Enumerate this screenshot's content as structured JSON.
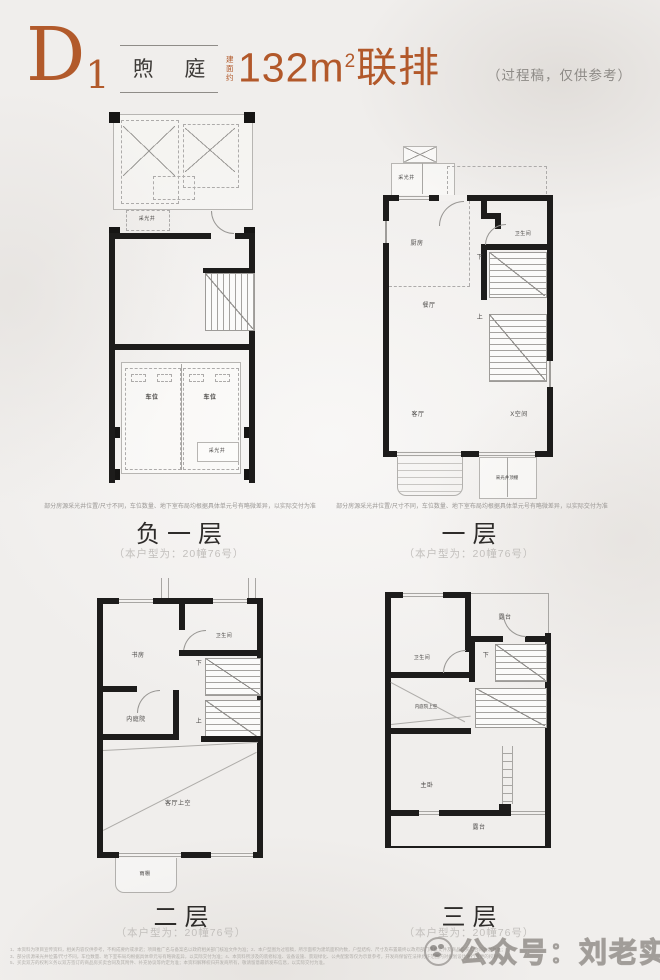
{
  "header": {
    "type_letter": "D",
    "type_number": "1",
    "name": "煦 庭",
    "area_prefix": "建面约",
    "area_value": "132m",
    "area_sup": "2",
    "area_type": "联排",
    "note": "（过程稿，仅供参考）",
    "accent_color": "#b2582a"
  },
  "caption": "（本户型为：20幢76号）",
  "disclaimer": "部分房源采光井位置/尺寸不同，车位数量、地下室布局均根据具体单元号有略微差异，以实际交付为准",
  "plans": {
    "basement": {
      "title": "负一层",
      "labels": {
        "lightwell_top": "采光井",
        "parking_left": "车位",
        "parking_right": "车位",
        "lightwell_bottom": "采光井"
      }
    },
    "floor1": {
      "title": "一层",
      "labels": {
        "lightwell": "采光井",
        "kitchen": "厨房",
        "bath": "卫生间",
        "down": "下",
        "up": "上",
        "dining": "餐厅",
        "living": "客厅",
        "xspace": "X空间",
        "lightwell_cover": "采光井顶棚"
      }
    },
    "floor2": {
      "title": "二层",
      "labels": {
        "study": "书房",
        "bath": "卫生间",
        "down": "下",
        "up": "上",
        "courtyard": "内庭院",
        "void_over_living": "客厅上空",
        "canopy": "雨棚"
      }
    },
    "floor3": {
      "title": "三层",
      "labels": {
        "bath": "卫生间",
        "terrace_top": "露台",
        "down": "下",
        "courtyard_void": "内庭院上空",
        "master": "主卧",
        "terrace_bottom": "露台"
      }
    }
  },
  "footer": {
    "watermark": "公众号：刘老实选房",
    "fine_print": {
      "line1": "1、本资料为项目宣传资料，相关内容仅供参考，不构成要约或承诺；项目推广名与备案名以政府相关部门核准文件为准；2、本户型图为过程稿，所示面积为建筑面积约数，户型结构、尺寸及布置最终以政府部门审批文件及商品房买卖合同约定为准；",
      "line2": "3、部分房源采光井位置/尺寸不同，车位数量、地下室布局均根据具体单元号有略微差异，以实际交付为准；4、本资料所涉及的装修标准、设备设施、景观绿化、公共配套等仅为示意参考，开发商保留在法律允许范围内对规划设计进行变更的权利；",
      "line3": "5、买卖双方的权利义务以双方签订的商品房买卖合同及其附件、补充协议等约定为准；本资料解释权归开发商所有，敬请留意最新发布信息，以实际交付为准。"
    }
  }
}
